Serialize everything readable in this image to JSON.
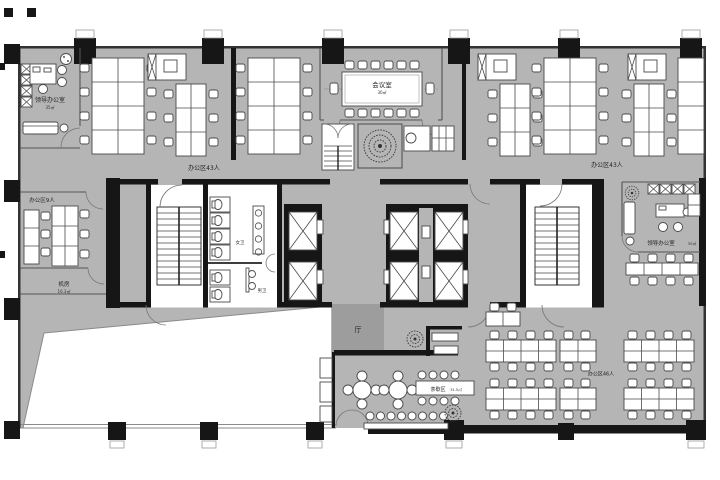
{
  "drawing": {
    "type": "office-floor-plan"
  },
  "colors": {
    "floor": "#b5b5b5",
    "hall_floor": "#9d9d9d",
    "wall": "#161616",
    "furniture": "#ffffff",
    "background": "#ffffff"
  },
  "rooms": {
    "leader_office_left": {
      "label": "领导办公室",
      "area": "35㎡"
    },
    "office_area_top_left": {
      "label": "办公区43人"
    },
    "meeting_room": {
      "label": "会议室",
      "area": "30㎡"
    },
    "office_area_top_right": {
      "label": "办公区43人"
    },
    "office_area_9": {
      "label": "办公区9人"
    },
    "machine_room": {
      "label": "机房",
      "area": "16.3㎡"
    },
    "women_restroom": {
      "label": "女卫"
    },
    "men_restroom": {
      "label": "男卫"
    },
    "leader_office_right": {
      "label": "领导办公室",
      "area": "35㎡"
    },
    "office_area_46": {
      "label": "办公区46人"
    },
    "hall": {
      "label": "厅"
    },
    "tea_break_area": {
      "label": "茶歇区",
      "area": "31.5㎡"
    }
  }
}
